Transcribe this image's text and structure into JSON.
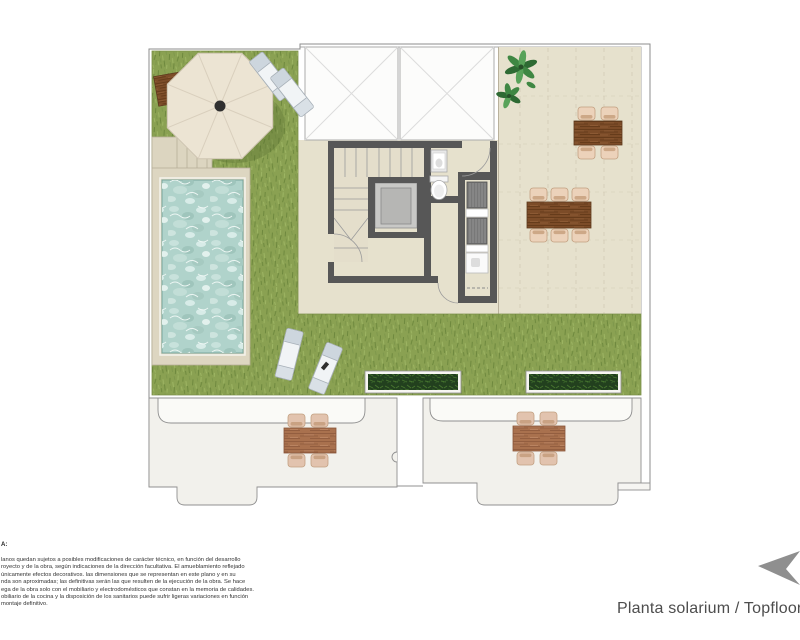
{
  "title": {
    "label": "Planta solarium / Topfloor"
  },
  "note": {
    "heading": "A:",
    "lines": [
      "lanos quedan sujetos a posibles modificaciones de carácter técnico, en función del desarrollo",
      "royecto y de la obra, según indicaciones de la dirección facultativa. El amueblamiento reflejado",
      "únicamente efectos decorativos. las dimensiones que se representan en este plano y en su",
      "nda son aproximadas; las definitivas serán las que resulten de la ejecución de la obra. Se hace",
      "ega de la obra solo con el mobiliario y electrodomésticos que constan en la memoria de calidades.",
      "obiliario de la cocina y la disposición de los sanitarios puede sufrir ligeras variaciones en función",
      "montaje definitivo."
    ]
  },
  "plan": {
    "colors": {
      "grass": "#8aa152",
      "terrace": "#e6e1cd",
      "pool_water": "#b0d3cb",
      "pool_deck": "#ddd6c1",
      "wall": "#575757",
      "wood_dark": "#7c4c28",
      "wood_light": "#a9714e",
      "chair": "#ecd2ba",
      "lounger": "#f1f4f6",
      "planter": "#22401e",
      "lower_terrace_floor": "#f2f1ec",
      "awning": "#fafaf7",
      "outline": "#8e8e8e",
      "umbrella": "#ece4d3",
      "plant_green": "#2e6a33",
      "logo_gray": "#8f8f8f"
    },
    "features": [
      "grass-lawn",
      "swimming-pool",
      "pool-deck",
      "pool-steps",
      "parasol",
      "sun-loungers",
      "skylights",
      "staircase",
      "elevator",
      "washbasin",
      "toilet",
      "utility-units",
      "planter-boxes",
      "dining-tables",
      "dining-chairs",
      "potted-plant",
      "terraces"
    ]
  },
  "logo": {
    "icon": "arrow-logo"
  }
}
